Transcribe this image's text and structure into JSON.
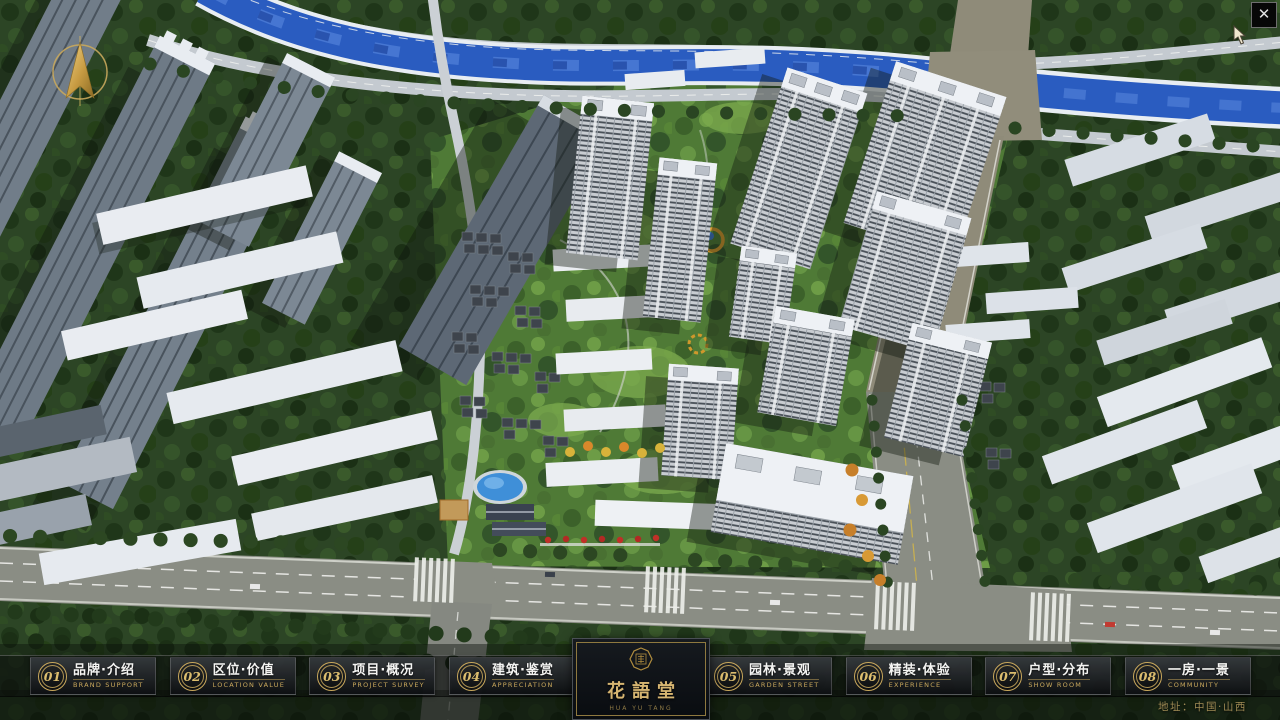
{
  "brand": {
    "name": "花語堂",
    "tagline": "HUA YU TANG"
  },
  "menu": {
    "items": [
      {
        "num": "01",
        "zh": "品牌·介绍",
        "en": "BRAND SUPPORT"
      },
      {
        "num": "02",
        "zh": "区位·价值",
        "en": "LOCATION VALUE"
      },
      {
        "num": "03",
        "zh": "项目·概况",
        "en": "PROJECT SURVEY"
      },
      {
        "num": "04",
        "zh": "建筑·鉴赏",
        "en": "APPRECIATION"
      },
      {
        "num": "05",
        "zh": "园林·景观",
        "en": "GARDEN STREET"
      },
      {
        "num": "06",
        "zh": "精装·体验",
        "en": "EXPERIENCE"
      },
      {
        "num": "07",
        "zh": "户型·分布",
        "en": "SHOW ROOM"
      },
      {
        "num": "08",
        "zh": "一房·一景",
        "en": "COMMUNITY"
      }
    ]
  },
  "footer": {
    "address": "地址：中国·山西"
  },
  "window_controls": {
    "close_glyph": "✕"
  },
  "icons": {
    "compass": "compass-north-arrow",
    "seal": "octagonal-brand-seal",
    "close": "x-glyph",
    "cursor": "mouse-pointer"
  },
  "colors": {
    "accent_gold": "#c9a85c",
    "gold_dark": "#8f793f",
    "bar_bg": "rgba(13,15,18,0.9)",
    "panel_bg": "#0c0f13",
    "river_blue": "#2a5cc0",
    "tree_green": "#2c4525",
    "road_gray": "#8a8d84",
    "tower_roof": "#eef1f5"
  }
}
